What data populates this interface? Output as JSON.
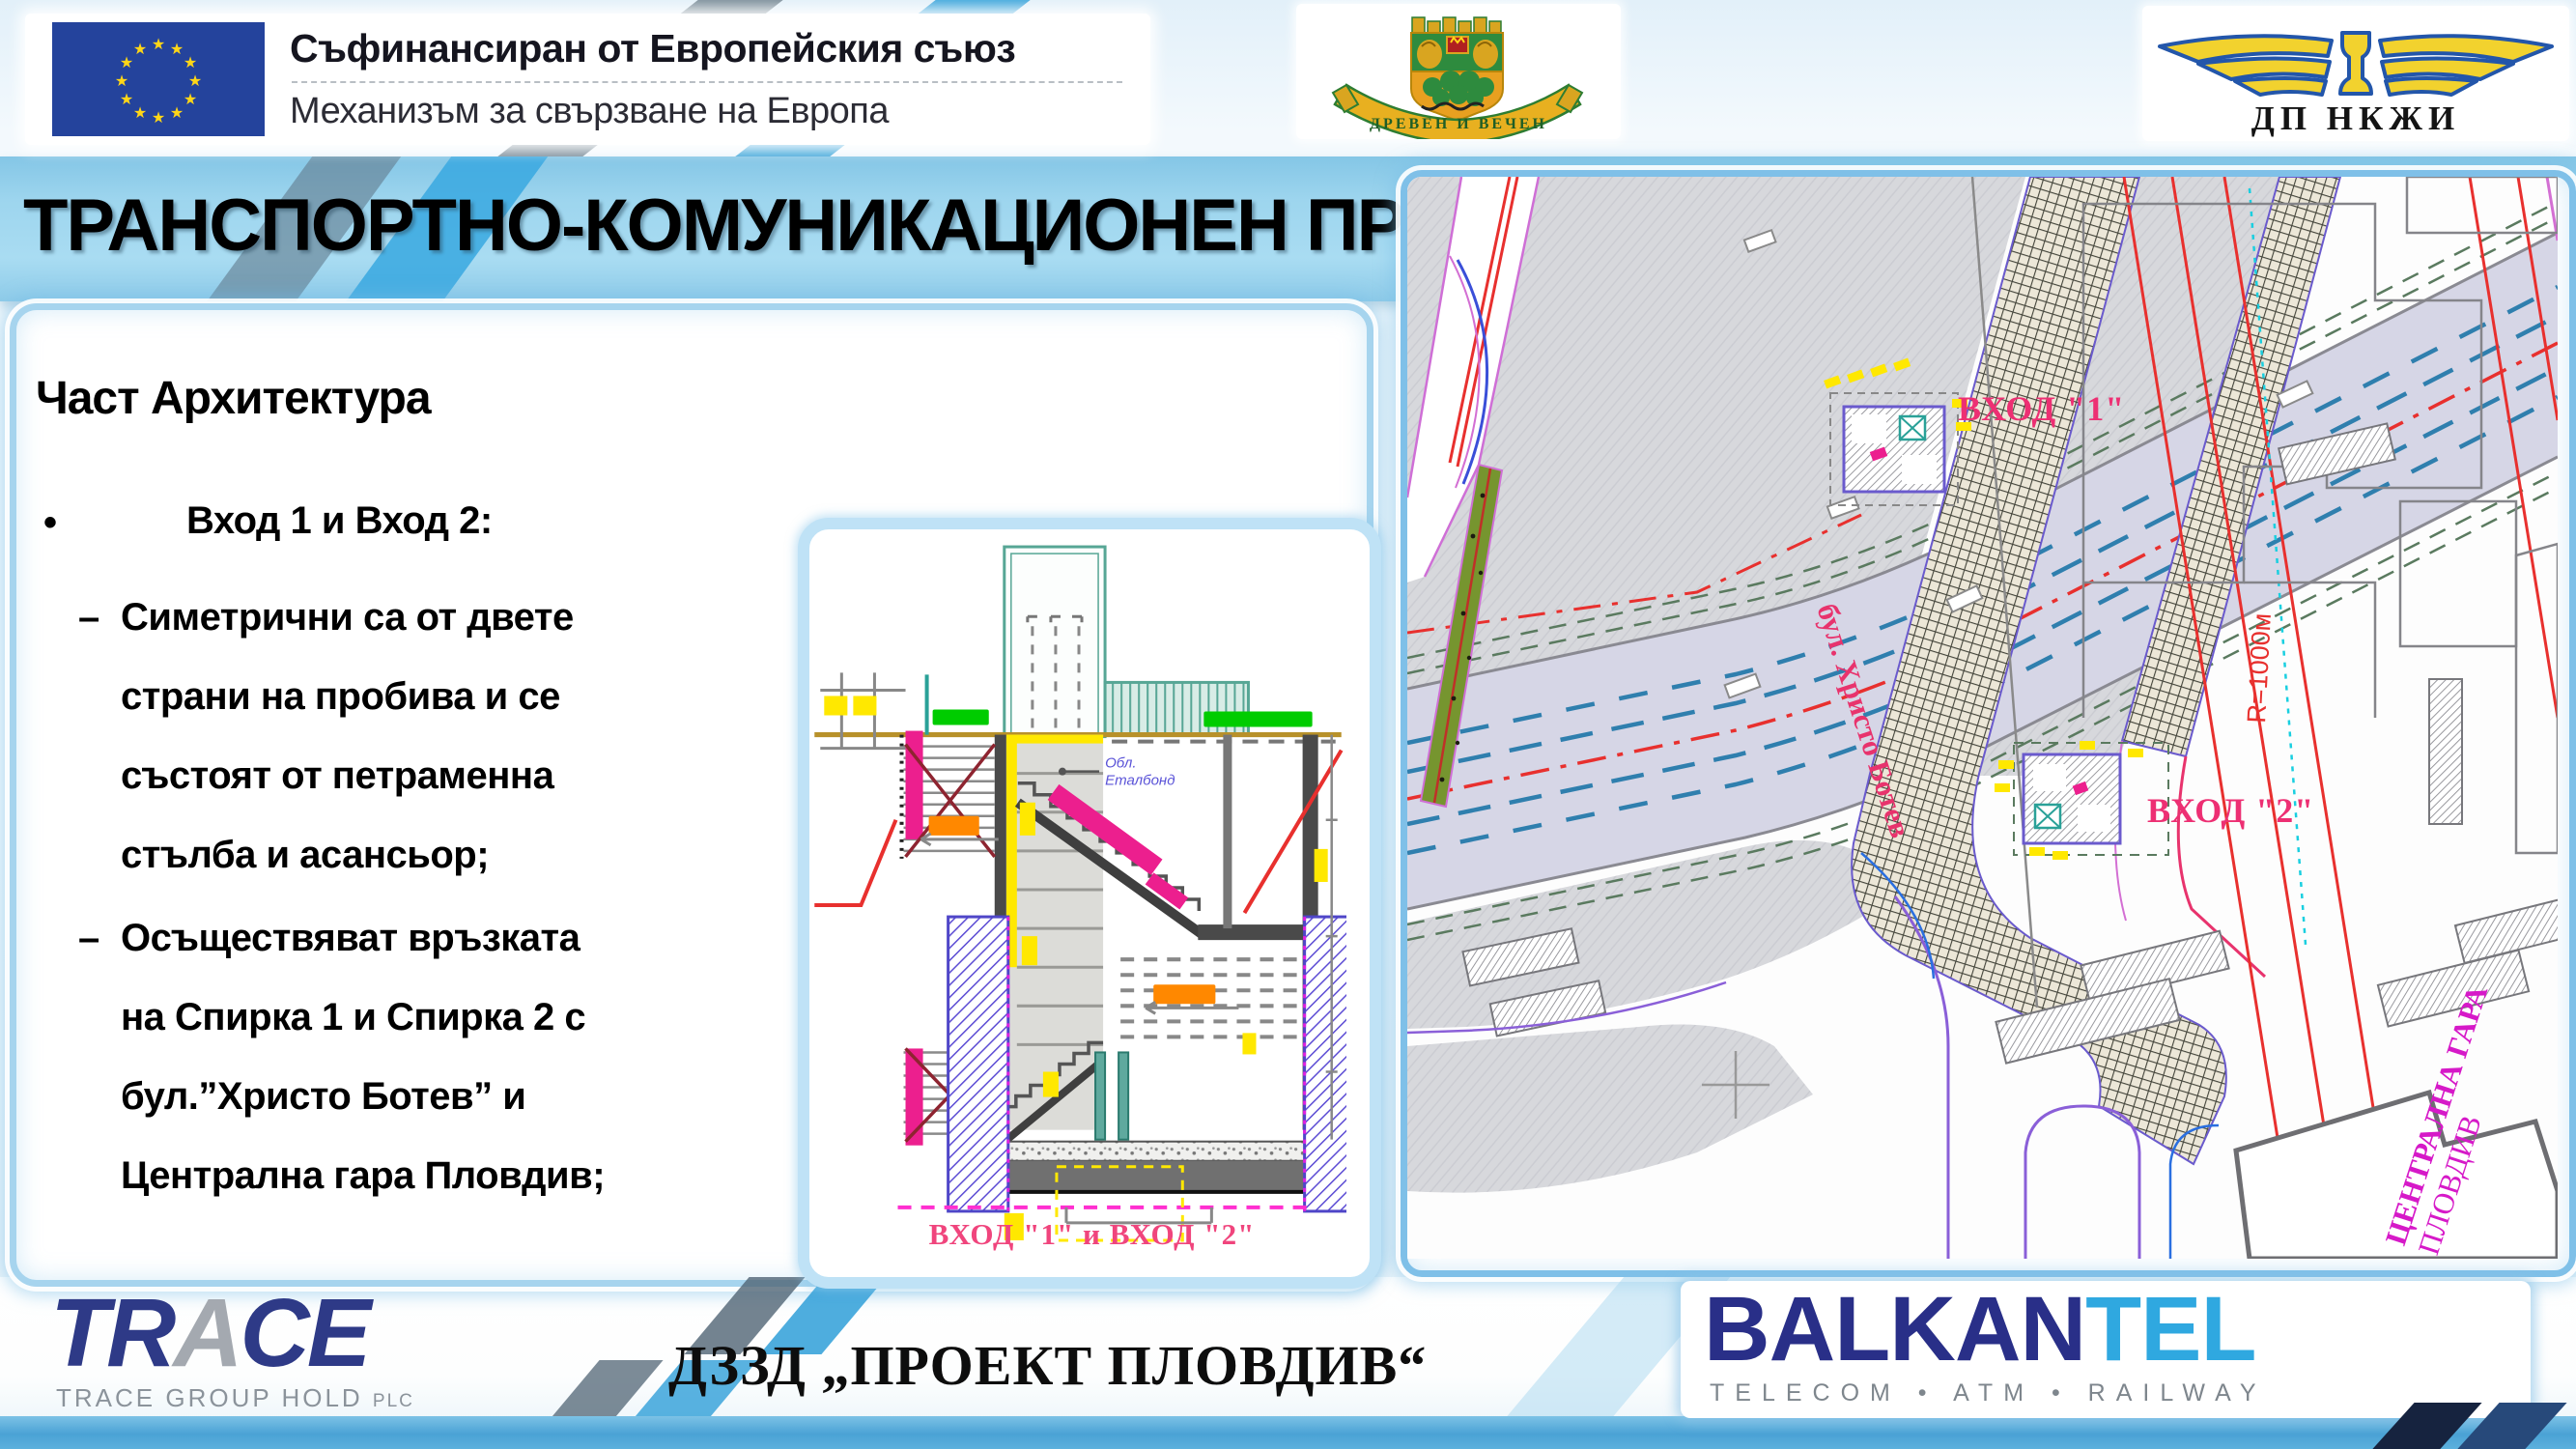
{
  "header": {
    "eu_block": {
      "line1": "Съфинансиран от Европейския съюз",
      "line2": "Механизъм за свързване на Европа"
    },
    "plovdiv_emblem": {
      "motto": "ДРЕВЕН И ВЕЧЕН"
    },
    "railway_logo": {
      "label": "ДП НКЖИ"
    }
  },
  "title_banner": {
    "text": "ТРАНСПОРТНО-КОМУНИКАЦИОНЕН ПРОБИВ"
  },
  "left_panel": {
    "heading": "Част Архитектура",
    "bullet_glyph": "•",
    "dash_glyph": "–",
    "bullet_text": "Вход 1 и Вход 2:",
    "sub1": [
      "Симетрични са от двете",
      "страни на пробива и се",
      "състоят от петраменна",
      "стълба и асансьор;"
    ],
    "sub2": [
      "Осъществяват връзката",
      "на Спирка 1 и Спирка 2 с",
      "бул.”Христо Ботев” и",
      "Централна гара Пловдив;"
    ]
  },
  "section_drawing": {
    "caption": "ВХОД \"1\" и ВХОД \"2\"",
    "cladding_note_1": "Обл.",
    "cladding_note_2": "Еталбонд"
  },
  "site_plan": {
    "entrance_1": "ВХОД \"1\"",
    "entrance_2": "ВХОД \"2\"",
    "street": "бул. Христо Ботев",
    "curve_radius": "R=1000м",
    "station_1": "ЦЕНТРАЛНА ГАРА",
    "station_2": "ПЛОВДИВ"
  },
  "footer": {
    "trace_t1": "TR",
    "trace_t2": "A",
    "trace_t3": "CE",
    "trace_sub": "TRACE GROUP HOLD",
    "trace_plc": "PLC",
    "consortium": "ДЗЗД  „ПРОЕКТ ПЛОВДИВ“",
    "balkantel_1": "BALKAN",
    "balkantel_2": "TEL",
    "balkantel_sub": "TELECOM  •  ATM  •  RAILWAY"
  },
  "colors": {
    "accent_blue": "#4aa2d5",
    "banner_blue": "#9dd5ee",
    "label_pink": "#ed2f73",
    "station_magenta": "#d619c8",
    "railline_red": "#e8302e",
    "eu_blue": "#24439c",
    "trace_navy": "#2e3a87",
    "balkantel_cyan": "#2fa8e0"
  }
}
